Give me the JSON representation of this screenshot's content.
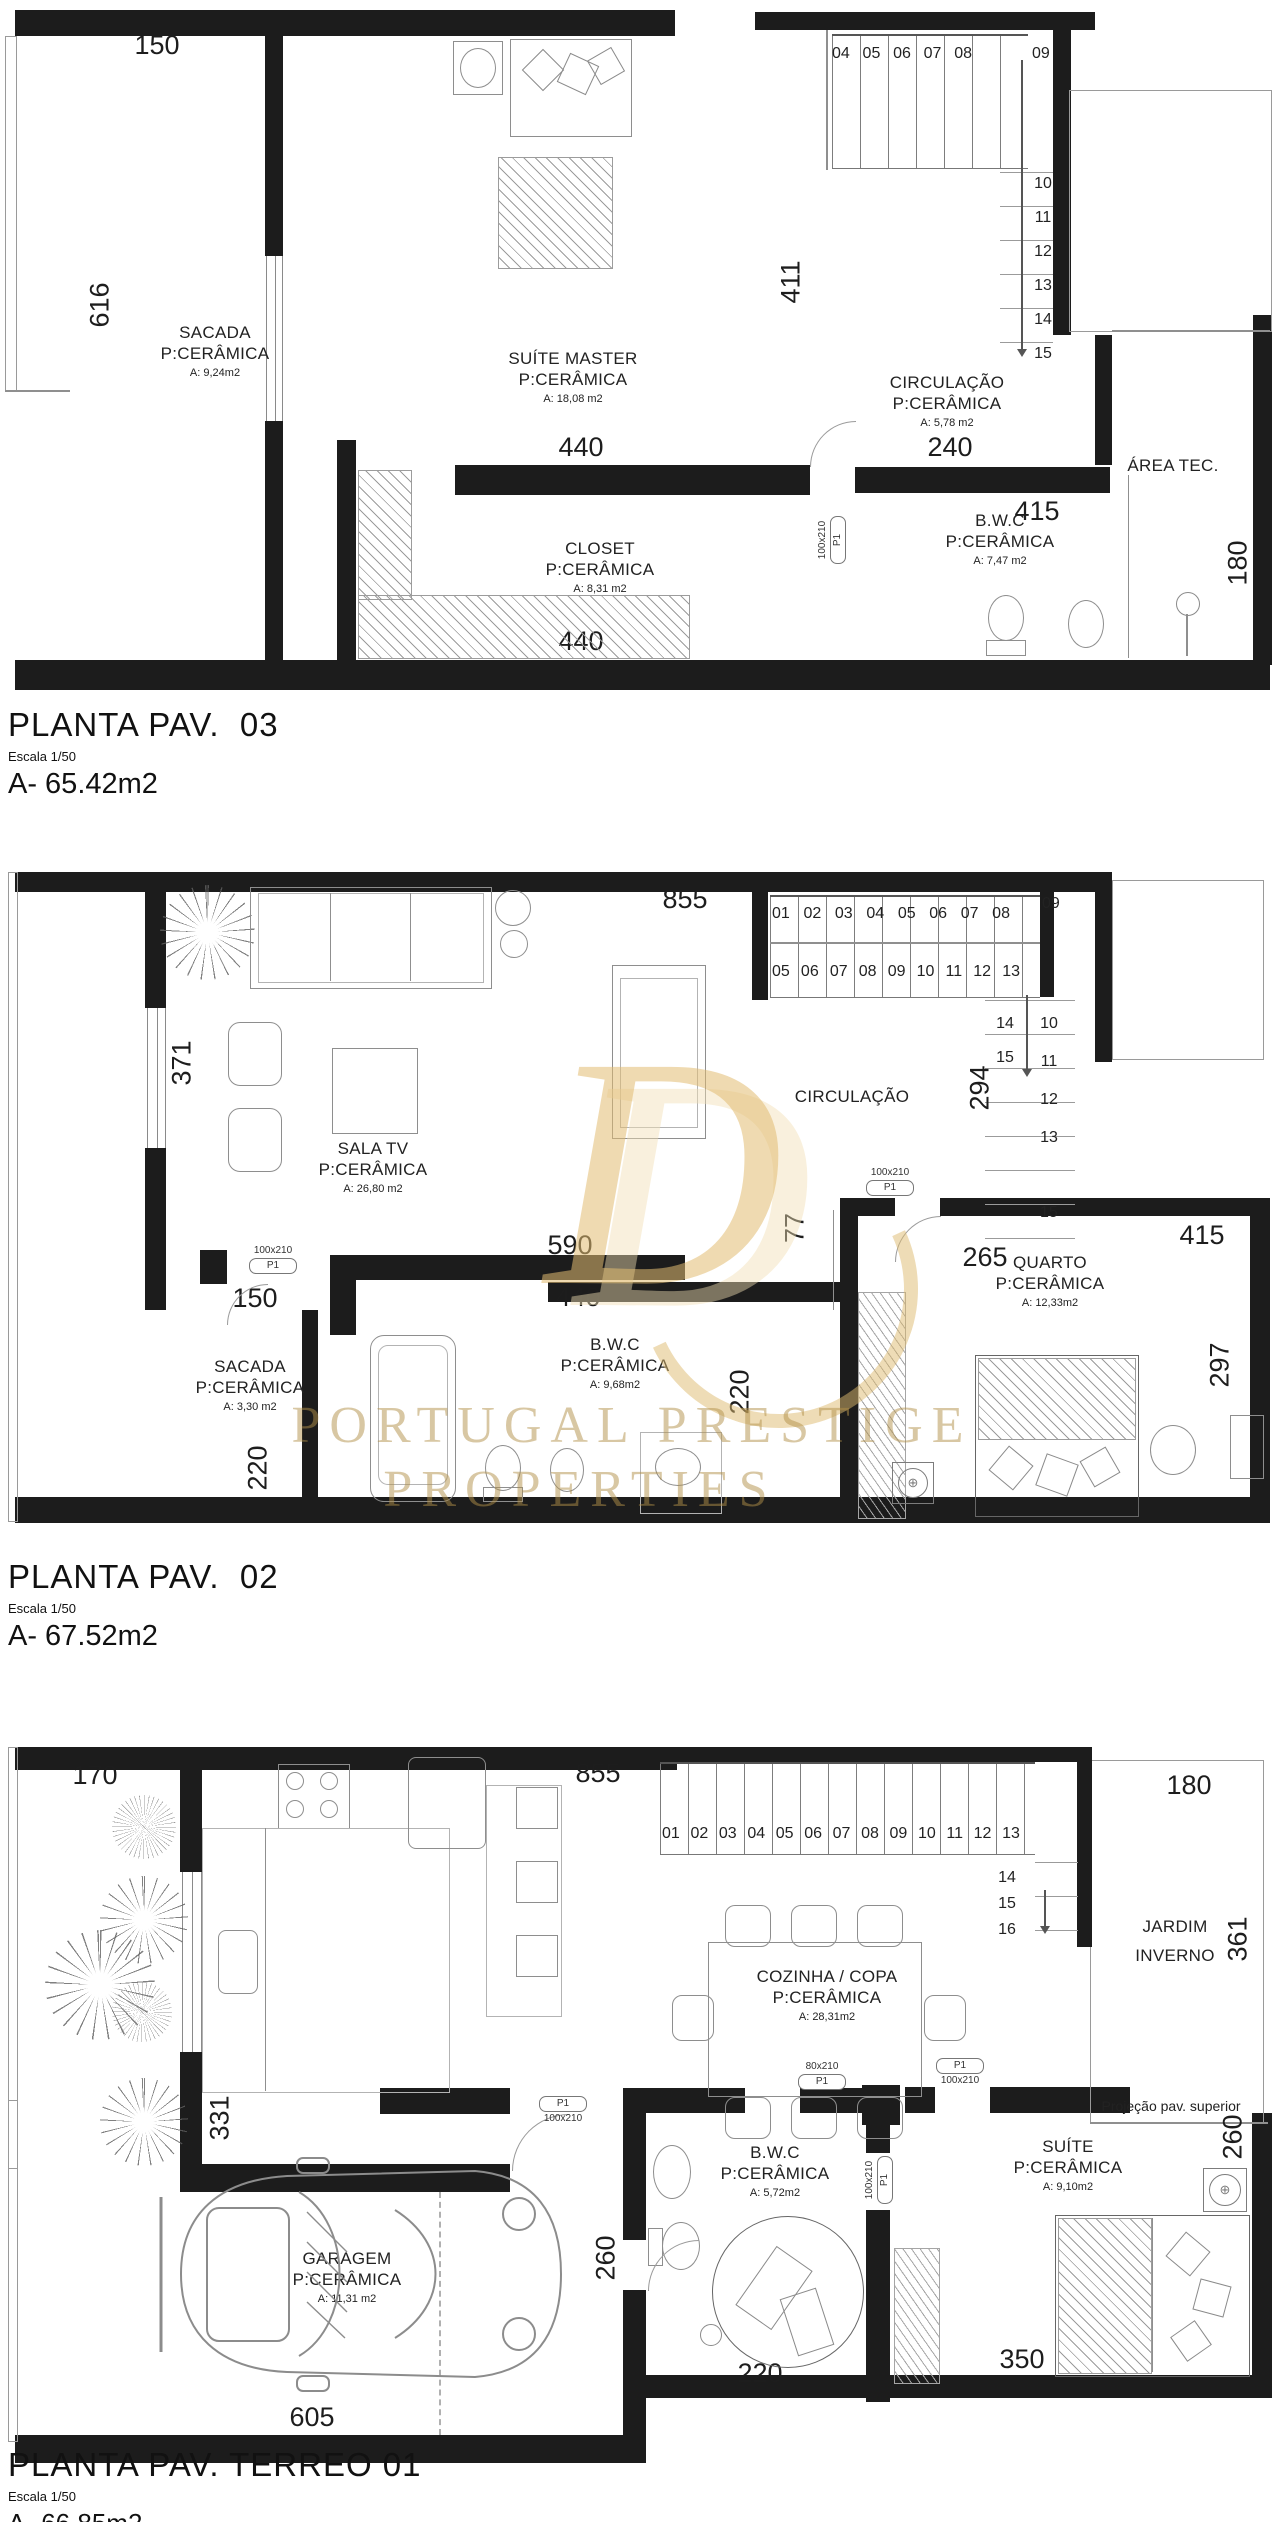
{
  "watermark": {
    "monogram": "D",
    "line1": "PORTUGAL PRESTIGE",
    "line2": "PROPERTIES",
    "gold": "#d9b25f"
  },
  "door_labels": {
    "p1": "P1",
    "s100": "100x210",
    "s80": "80x210"
  },
  "icons": {
    "fan": "⊕"
  },
  "plans": {
    "p3": {
      "title": "PLANTA PAV.  03",
      "scale": "Escala 1/50",
      "area": "A- 65.42m2",
      "rooms": {
        "sacada": {
          "name": "SACADA",
          "floor": "P:CERÂMICA",
          "area": "A: 9,24m2"
        },
        "suite": {
          "name": "SUÍTE MASTER",
          "floor": "P:CERÂMICA",
          "area": "A: 18,08 m2"
        },
        "circ": {
          "name": "CIRCULAÇÃO",
          "floor": "P:CERÂMICA",
          "area": "A: 5,78 m2"
        },
        "closet": {
          "name": "CLOSET",
          "floor": "P:CERÂMICA",
          "area": "A: 8,31 m2"
        },
        "bwc": {
          "name": "B.W.C",
          "floor": "P:CERÂMICA",
          "area": "A: 7,47 m2"
        },
        "areatec": {
          "name": "ÁREA TEC."
        }
      },
      "dims": {
        "d150": "150",
        "d616": "616",
        "d411": "411",
        "d440a": "440",
        "d240": "240",
        "d415": "415",
        "d440b": "440",
        "d180": "180"
      },
      "stairs": {
        "row": [
          "04",
          "05",
          "06",
          "07",
          "08"
        ],
        "row_last": "09",
        "col": [
          "10",
          "11",
          "12",
          "13",
          "14",
          "15"
        ]
      }
    },
    "p2": {
      "title": "PLANTA PAV.  02",
      "scale": "Escala 1/50",
      "area": "A- 67.52m2",
      "rooms": {
        "sala": {
          "name": "SALA TV",
          "floor": "P:CERÂMICA",
          "area": "A: 26,80 m2"
        },
        "circ": {
          "name": "CIRCULAÇÃO"
        },
        "quarto": {
          "name": "QUARTO",
          "floor": "P:CERÂMICA",
          "area": "A: 12,33m2"
        },
        "sacada": {
          "name": "SACADA",
          "floor": "P:CERÂMICA",
          "area": "A: 3,30 m2"
        },
        "bwc": {
          "name": "B.W.C",
          "floor": "P:CERÂMICA",
          "area": "A: 9,68m2"
        }
      },
      "dims": {
        "d855": "855",
        "d371": "371",
        "d294": "294",
        "d265": "265",
        "d77": "77",
        "d415": "415",
        "d297": "297",
        "d590": "590",
        "d440": "440",
        "d150": "150",
        "d220a": "220",
        "d220b": "220"
      },
      "stairs": {
        "row1": [
          "01",
          "02",
          "03",
          "04",
          "05",
          "06",
          "07",
          "08"
        ],
        "row1_last": "09",
        "row2": [
          "05",
          "06",
          "07",
          "08",
          "09",
          "10",
          "11",
          "12",
          "13"
        ],
        "left_col": [
          "14",
          "15"
        ],
        "right_col": [
          "10",
          "11",
          "12",
          "13"
        ],
        "right_last": "15"
      }
    },
    "p1": {
      "title": "PLANTA PAV. TERREO 01",
      "scale": "Escala 1/50",
      "area": "A- 66.85m2",
      "rooms": {
        "cozinha": {
          "name": "COZINHA / COPA",
          "floor": "P:CERÂMICA",
          "area": "A: 28,31m2"
        },
        "jardim": {
          "line1": "JARDIM",
          "line2": "INVERNO"
        },
        "garagem": {
          "name": "GARAGEM",
          "floor": "P:CERÂMICA",
          "area": "A: 11,31 m2"
        },
        "bwc": {
          "name": "B.W.C",
          "floor": "P:CERÂMICA",
          "area": "A: 5,72m2"
        },
        "suite": {
          "name": "SUÍTE",
          "floor": "P:CERÂMICA",
          "area": "A: 9,10m2"
        },
        "projecao": "Projeção pav. superior"
      },
      "dims": {
        "d170": "170",
        "d855": "855",
        "d180": "180",
        "d331": "331",
        "d361": "361",
        "d605": "605",
        "d260a": "260",
        "d220": "220",
        "d350": "350",
        "d260b": "260"
      },
      "stairs": {
        "row": [
          "01",
          "02",
          "03",
          "04",
          "05",
          "06",
          "07",
          "08",
          "09",
          "10",
          "11",
          "12",
          "13"
        ],
        "col": [
          "14",
          "15",
          "16"
        ]
      }
    }
  }
}
